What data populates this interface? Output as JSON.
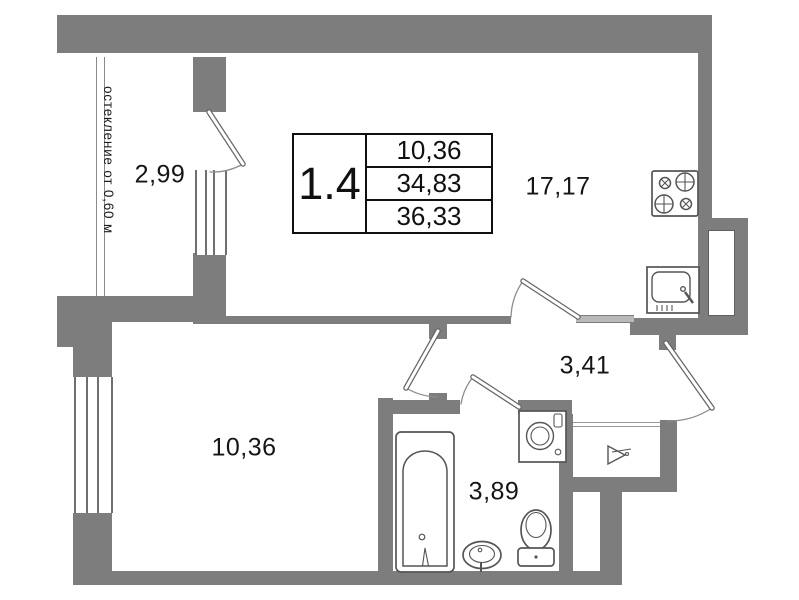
{
  "info_table": {
    "unit": "1.4",
    "rows": [
      "10,36",
      "34,83",
      "36,33"
    ]
  },
  "rooms": [
    {
      "name": "balcony",
      "area": "2,99"
    },
    {
      "name": "kitchen-living-room",
      "area": "17,17"
    },
    {
      "name": "bedroom",
      "area": "10,36"
    },
    {
      "name": "hallway",
      "area": "3,41"
    },
    {
      "name": "bathroom",
      "area": "3,89"
    }
  ],
  "annotations": {
    "glazing_note": "остекление от 0,60 м"
  },
  "icons": [
    "stove-icon",
    "kitchen-sink-icon",
    "washing-machine-icon",
    "bathtub-icon",
    "bathroom-sink-icon",
    "toilet-icon",
    "hanger-icon"
  ],
  "colors": {
    "wall": "#7d7d7d",
    "wall_light": "#b9b9b9",
    "fixture_line": "#555555",
    "text": "#151515",
    "table_border": "#101010",
    "background": "#ffffff"
  }
}
